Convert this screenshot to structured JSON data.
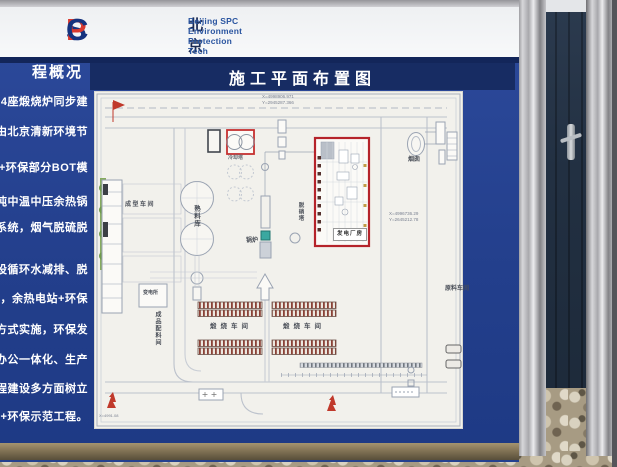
{
  "header": {
    "logo_s": "S",
    "logo_p": "P",
    "logo_c": "C",
    "company_cn": "北京清新环境技术股份有限公司",
    "company_en": "Beijing SPC Environment Protection Tech CO.,Ltd"
  },
  "sidebar": {
    "heading": "程概况",
    "lines": [
      "64座煅烧炉同步建",
      "由北京清新环境节",
      "C+环保部分BOT模",
      "吨中温中压余热锅",
      "保系统，烟气脱硫脱",
      "步建设循环水减排、脱",
      "投运，余热电站+环保",
      "设的方式实施，环保发",
      "生产办公一体化、生产",
      "程、工程建设多方面树立",
      "电+环保示范工程。"
    ]
  },
  "plan": {
    "title": "施工平面布置图",
    "coords_top_x": "X=4998906.971",
    "coords_top_y": "Y=2945287.366",
    "coords_right_x": "X=4996736.29",
    "coords_right_y": "Y=2645212.78",
    "coords_bottom": "X=4991.08",
    "labels": {
      "cooling_tower": "冷却塔",
      "clinker_silo": "熟料库",
      "forming_workshop": "成型车间",
      "substation": "变电所",
      "product_batching": "成品配料间",
      "calcining_left": "煅烧车间",
      "calcining_right": "煅烧车间",
      "boiler": "锅炉",
      "denitration_tower": "脱硝塔",
      "power_house": "发电厂房",
      "chimney": "烟囱",
      "raw_material_workshop": "原料车间"
    }
  },
  "colors": {
    "board_blue": "#24418f",
    "title_bar_blue": "#172c63",
    "logo_blue": "#15337f",
    "logo_red": "#d93a30",
    "plan_red_accent": "#b5232a",
    "boiler_teal": "#3aa8a0",
    "tree_green": "#86ab5f",
    "container_navy": "#223042",
    "frame_bronze": "#7b6c50"
  }
}
